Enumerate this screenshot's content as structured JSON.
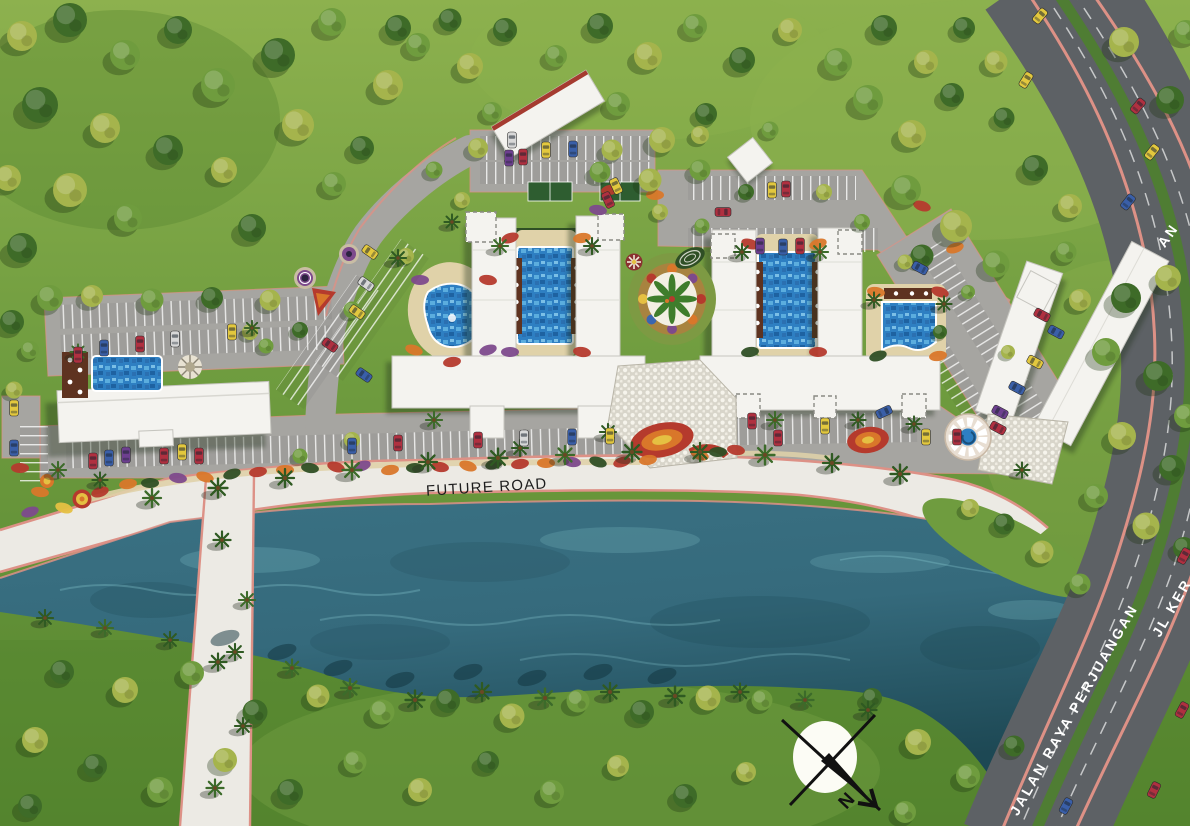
{
  "labels": {
    "future_road": "FUTURE ROAD",
    "main_road": "JALAN RAYA PERJUANGAN",
    "side_road_partial": "JL KER",
    "top_road_partial": "AN",
    "compass_north": "N"
  },
  "colors": {
    "grass": "#6f9c3f",
    "grass_dark": "#54842e",
    "grass_light": "#8db14e",
    "water": "#3a7183",
    "water_deep": "#1d4854",
    "water_light": "#8fd0d8",
    "road_internal": "#a6a5a1",
    "road_highway": "#5d6165",
    "road_future": "#eceae4",
    "curb_pink": "#dd9186",
    "median_green": "#4f7d33",
    "building_white": "#f4f3ef",
    "building_edge": "#c6c5bf",
    "pool_blue": "#2e7fc2",
    "deck_tan": "#e0d2a9",
    "deck_brown": "#5e3320",
    "plaza_dot": "#d8d5ca",
    "tree_dark": "#3e6b28",
    "tree_yellow": "#a5b44c",
    "tree_mid": "#6f9c3e",
    "palm_green": "#2f5a22",
    "hedge_green": "#2f4f25",
    "flower_red": "#b53a2d",
    "flower_orange": "#d9772a",
    "flower_purple": "#7d4a8c",
    "flower_yellow": "#e5c042",
    "car_red": "#b03040",
    "car_blue": "#3a5fa8",
    "car_yellow": "#e3c83e",
    "car_purple": "#6d3f8f",
    "car_silver": "#d8d8d8",
    "label_dark": "#1d1d1d",
    "label_light": "#ffffff",
    "compass_face": "#fcfcf5"
  }
}
